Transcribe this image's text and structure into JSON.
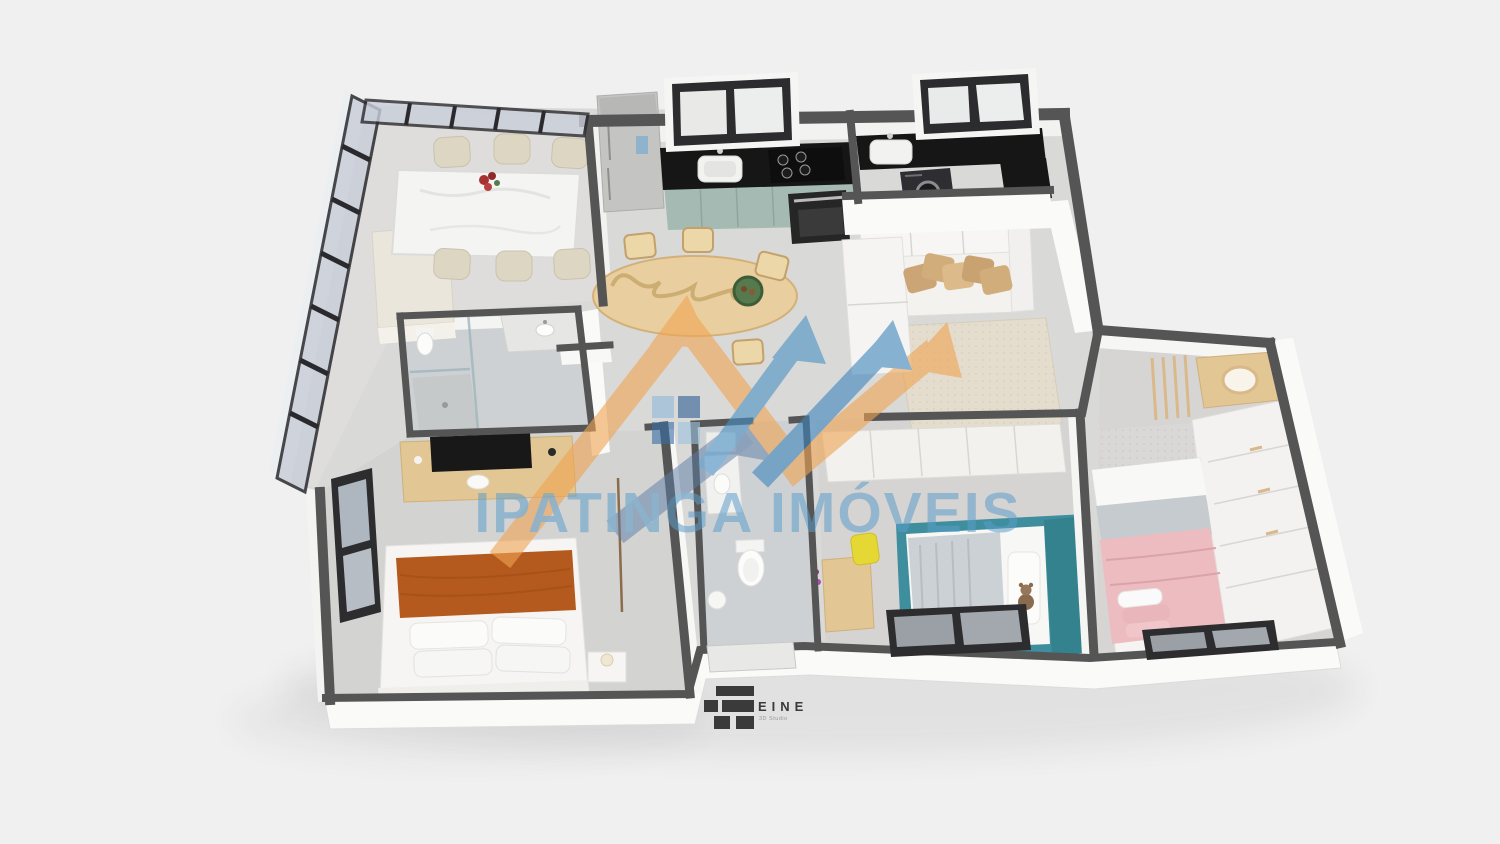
{
  "watermark": {
    "brand_text": "IPATINGA IMÓVEIS"
  },
  "studio_logo": {
    "brand_text": "EINE",
    "subtitle_text": "3D Studio"
  },
  "colors": {
    "background": "#f0f0f1",
    "floor": "#d9d9d8",
    "floor_balcony": "#dedddc",
    "tile": "#ced1d3",
    "wall_cap": "#555555",
    "wall_dark": "#474747",
    "wall_white": "#fafaf9",
    "frame_black": "#2c2c2e",
    "glass": "#c9cfd9",
    "counter_black": "#161616",
    "cabinet_sage": "#a4bab2",
    "fridge_silver": "#c4c4c2",
    "wood_table": "#e9cf9f",
    "wood_desk": "#e2c693",
    "marble_white": "#f4f4f2",
    "chair_beige": "#ddd6c2",
    "pillow_tan": "#d2ad7c",
    "rug_living": "#e4dccc",
    "rug_gray": "#dad8d6",
    "sofa_white": "#f3f2ef",
    "bed_white": "#f6f5f3",
    "throw_rust": "#b55a1e",
    "bed_teal": "#3e8e9d",
    "bed_teal_dark": "#35828f",
    "blanket_gray": "#ccd1d5",
    "blanket_pink": "#ecbcc0",
    "chair_yellow": "#e6d834",
    "bowl_green": "#567a4e",
    "flower_red": "#a83232",
    "washer_dark": "#2e2e32",
    "oven_dark": "#262626",
    "watermark_orange": "#f0a452",
    "watermark_blue": "#4a90c4",
    "watermark_blue_dark": "#2f5f97",
    "watermark_blue_mid": "#3a6ea8",
    "watermark_blue_light": "#8fb8d8",
    "watermark_steel": "#5d7fa8",
    "watermark_text": "#5b9dc9",
    "logo_dark": "#3a3a3a",
    "logo_sub": "#979797"
  }
}
